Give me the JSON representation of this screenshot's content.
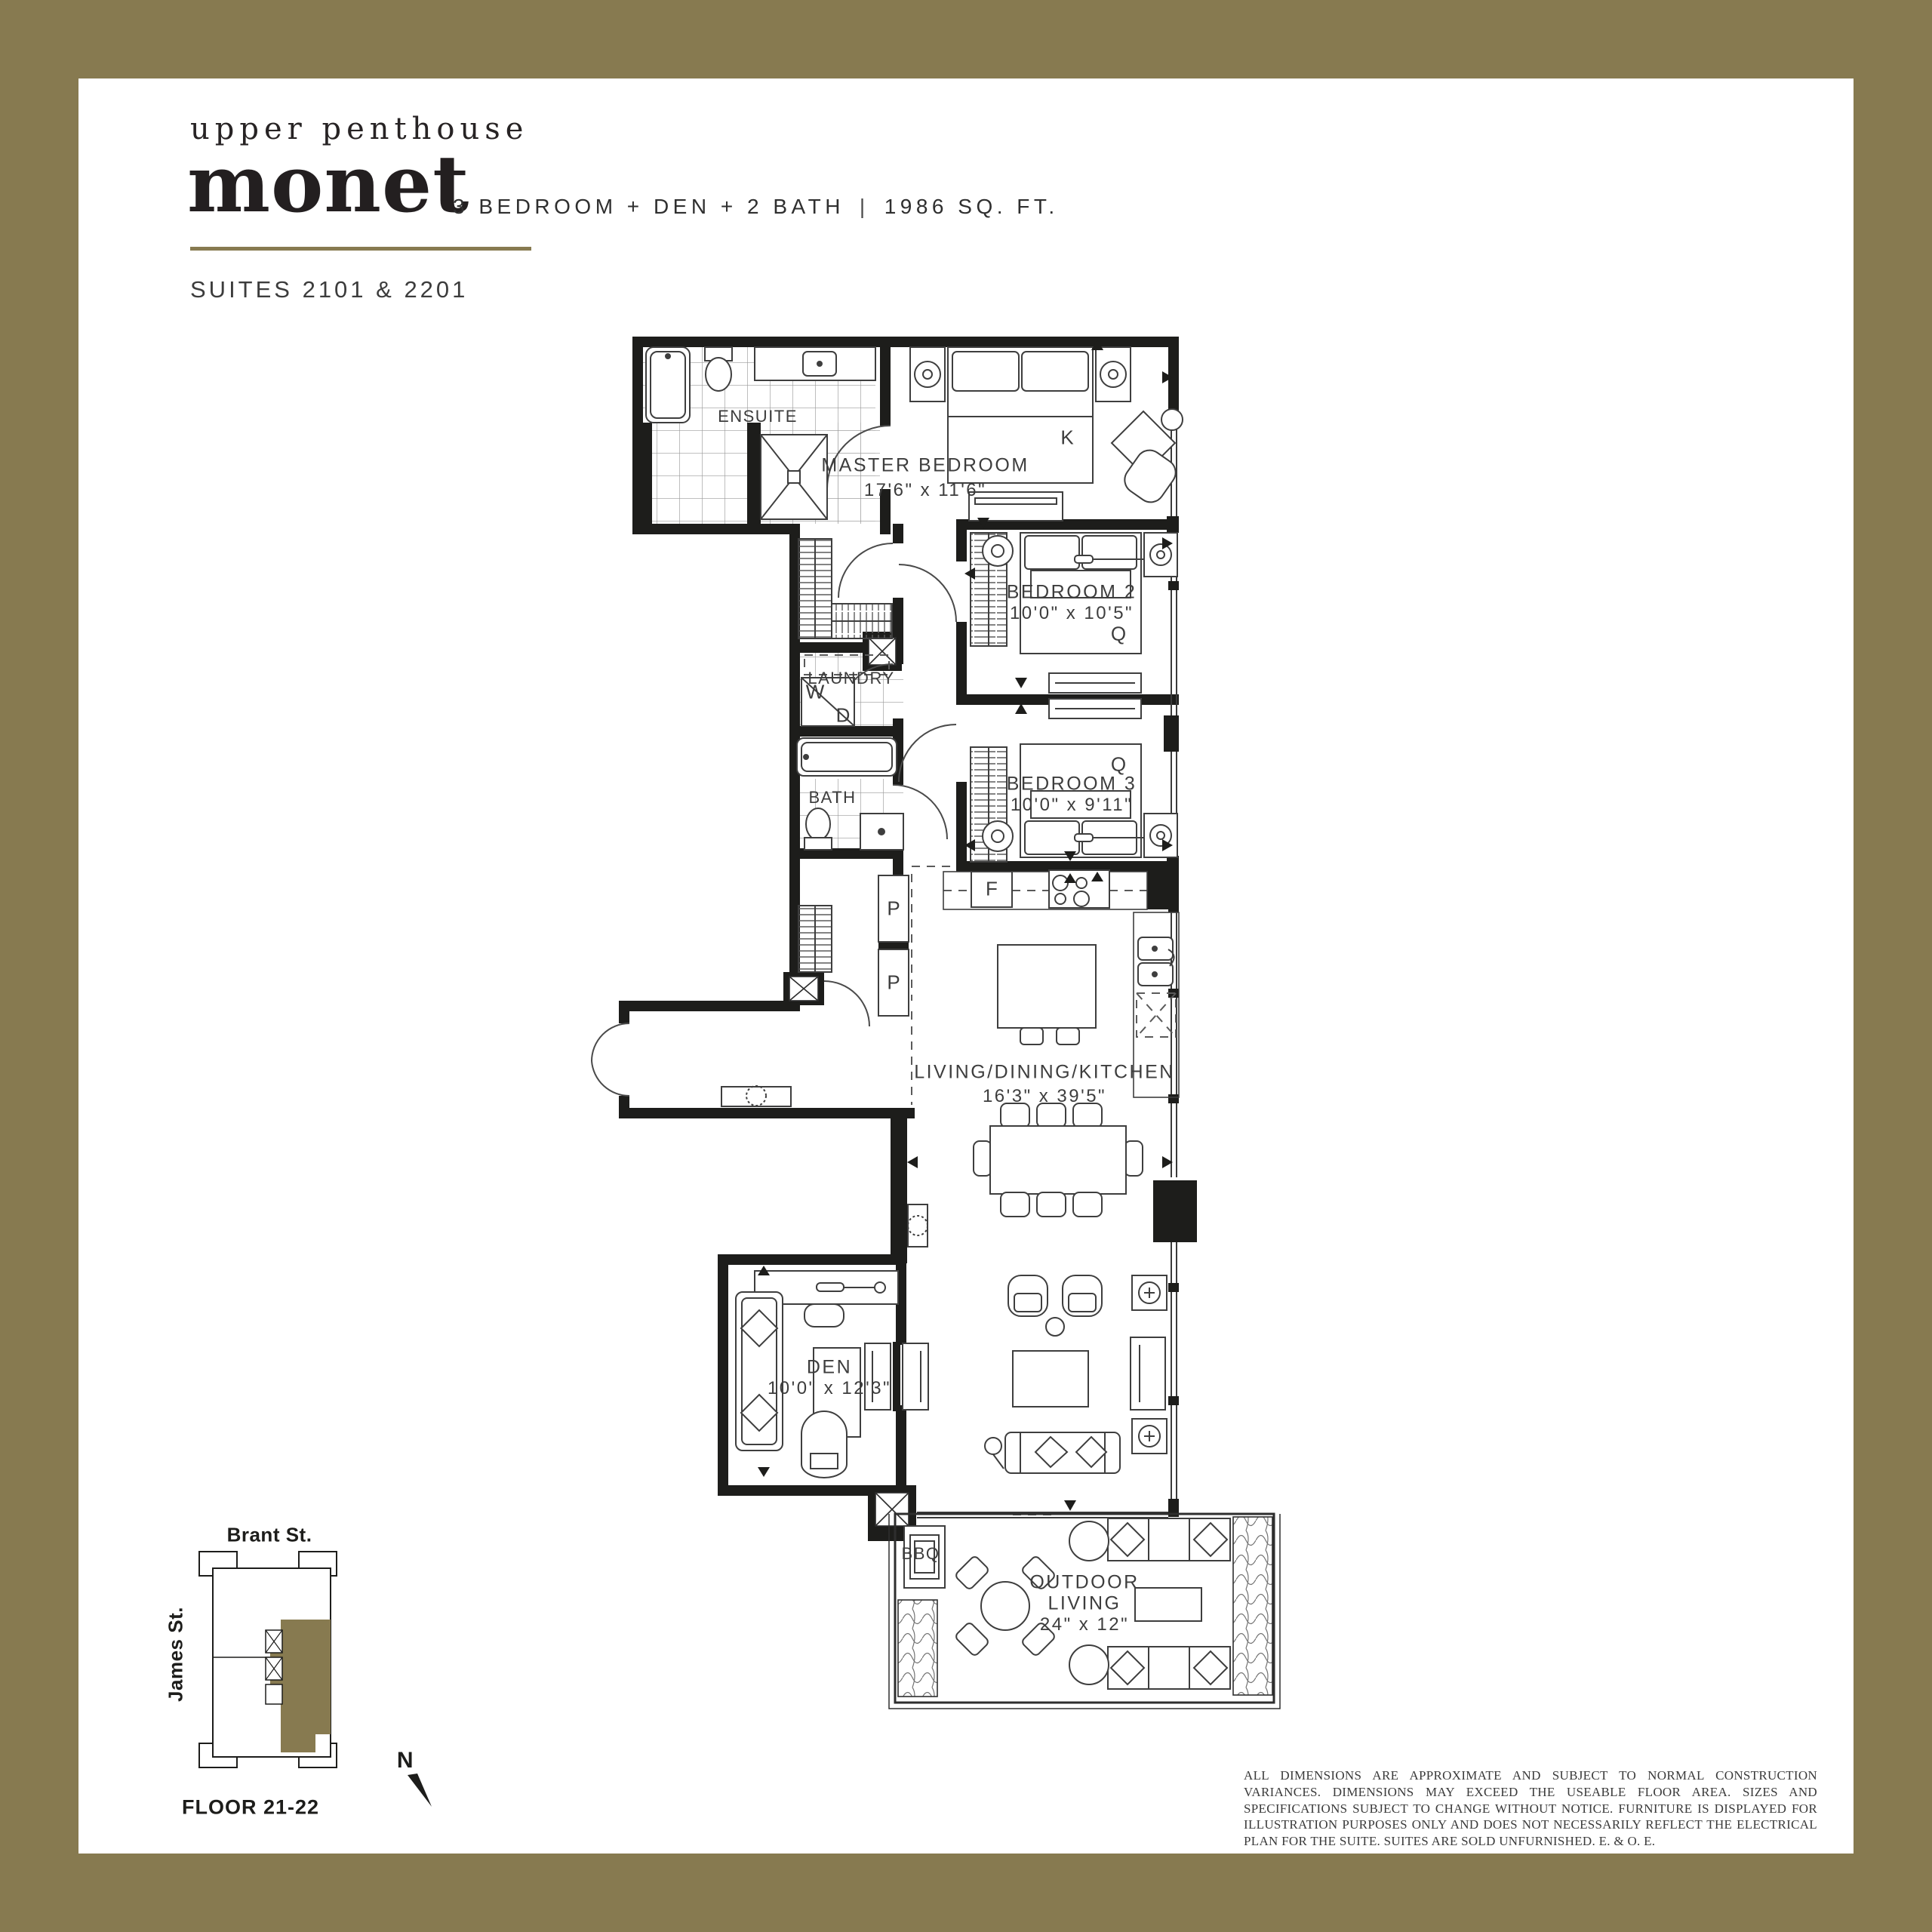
{
  "colors": {
    "accent": "#877A50",
    "wall": "#1D1D1B"
  },
  "header": {
    "eyebrow": "upper penthouse",
    "title": "monet",
    "spec_line": "3 BEDROOM + DEN + 2 BATH",
    "separator": "|",
    "area": "1986 SQ. FT.",
    "suites": "SUITES 2101 & 2201"
  },
  "floorplan": {
    "labels": {
      "ensuite": "ENSUITE",
      "master_name": "MASTER BEDROOM",
      "master_dims": "17'6\" x 11'6\"",
      "master_bed": "K",
      "bedroom2_name": "BEDROOM 2",
      "bedroom2_dims": "10'0\" x 10'5\"",
      "bedroom2_bed": "Q",
      "laundry": "LAUNDRY",
      "washer": "W",
      "dryer": "D",
      "bath": "BATH",
      "bedroom3_name": "BEDROOM 3",
      "bedroom3_dims": "10'0\" x 9'11\"",
      "bedroom3_bed": "Q",
      "fridge": "F",
      "pantry_upper": "P",
      "pantry_lower": "P",
      "living_name": "LIVING/DINING/KITCHEN",
      "living_dims": "16'3\" x 39'5\"",
      "den_name": "DEN",
      "den_dims": "10'0\" x 12'3\"",
      "outdoor_line1": "OUTDOOR",
      "outdoor_line2": "LIVING",
      "outdoor_dims": "24\" x 12\"",
      "bbq": "BBQ"
    }
  },
  "keyplan": {
    "street_top": "Brant St.",
    "street_left": "James St.",
    "floor_label": "FLOOR 21-22",
    "north": "N"
  },
  "disclaimer": "ALL DIMENSIONS ARE APPROXIMATE AND SUBJECT TO NORMAL CONSTRUCTION VARIANCES. DIMENSIONS MAY EXCEED THE USEABLE FLOOR AREA. SIZES AND SPECIFICATIONS SUBJECT TO CHANGE WITHOUT NOTICE. FURNITURE IS DISPLAYED FOR ILLUSTRATION PURPOSES ONLY AND DOES NOT NECESSARILY REFLECT THE ELECTRICAL PLAN FOR THE SUITE. SUITES ARE SOLD UNFURNISHED. E. & O. E."
}
